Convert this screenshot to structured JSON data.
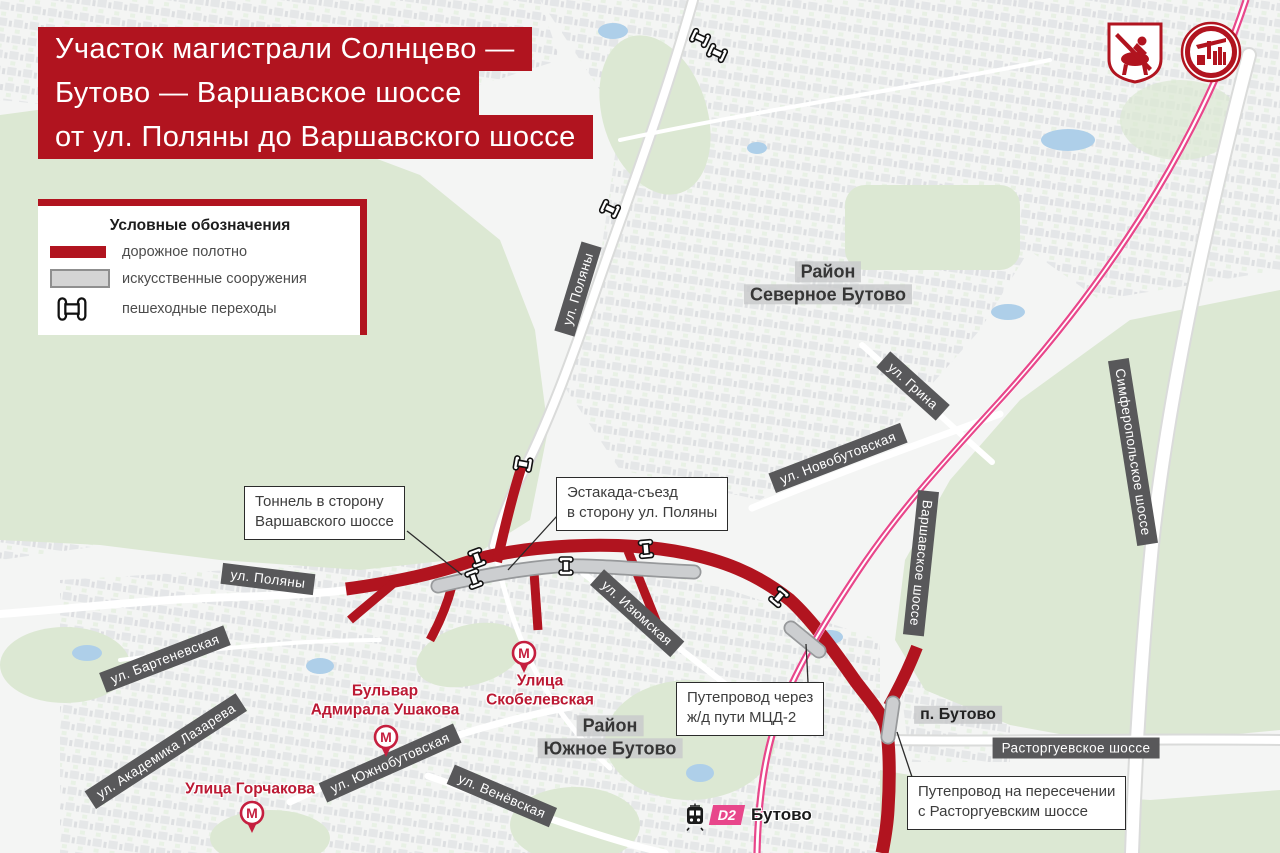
{
  "title": {
    "line1": "Участок магистрали Солнцево —",
    "line2": "Бутово — Варшавское шоссе",
    "line3": "от ул. Поляны до Варшавского шоссе"
  },
  "logos": {
    "moscow_coat_of_arms": "герб Москвы",
    "stroy_complex": "Стройкомплекс Москвы"
  },
  "legend": {
    "header": "Условные обозначения",
    "road_label": "дорожное полотно",
    "structures_label": "искусственные сооружения",
    "pedestrian_label": "пешеходные переходы"
  },
  "colors": {
    "road_red": "#b1141f",
    "structure_gray": "#ccced0",
    "railway_pink": "#e8478b",
    "chip_dark": "#58585a",
    "metro_red": "#c51f3f"
  },
  "districts": {
    "severnoye_butovo": {
      "line1": "Район",
      "line2": "Северное Бутово"
    },
    "yuzhnoye_butovo": {
      "line1": "Район",
      "line2": "Южное Бутово"
    },
    "p_butovo": "п. Бутово"
  },
  "streets": {
    "polyany_north": "ул. Поляны",
    "polyany_west": "ул. Поляны",
    "grina": "ул. Грина",
    "novobutovskaya": "ул. Новобутовская",
    "varshavskoye": "Варшавское шоссе",
    "simferopolskoye": "Симферопольское шоссе",
    "izyumskaya": "ул. Изюмская",
    "bartenevskaya": "ул. Бартеневская",
    "akademika_lazareva": "ул. Академика Лазарева",
    "yuzhnobutovskaya": "ул. Южнобутовская",
    "venevskaya": "ул. Венёвская",
    "rastorguyevskoye": "Расторгуевское шоссе"
  },
  "metro": {
    "letter": "М",
    "skobelevskaya": {
      "line1": "Улица",
      "line2": "Скобелевская"
    },
    "ushakova": {
      "line1": "Бульвар",
      "line2": "Адмирала Ушакова"
    },
    "gorchakova": {
      "line1": "Улица Горчакова"
    }
  },
  "callouts": {
    "tunnel": {
      "line1": "Тоннель в сторону",
      "line2": "Варшавского шоссе"
    },
    "ramp": {
      "line1": "Эстакада-съезд",
      "line2": "в сторону ул. Поляны"
    },
    "overpass_mcd": {
      "line1": "Путепровод через",
      "line2": "ж/д пути МЦД-2"
    },
    "overpass_rastorg": {
      "line1": "Путепровод на пересечении",
      "line2": "с Расторгуевским шоссе"
    }
  },
  "rail_station": {
    "badge": "D2",
    "name": "Бутово"
  }
}
